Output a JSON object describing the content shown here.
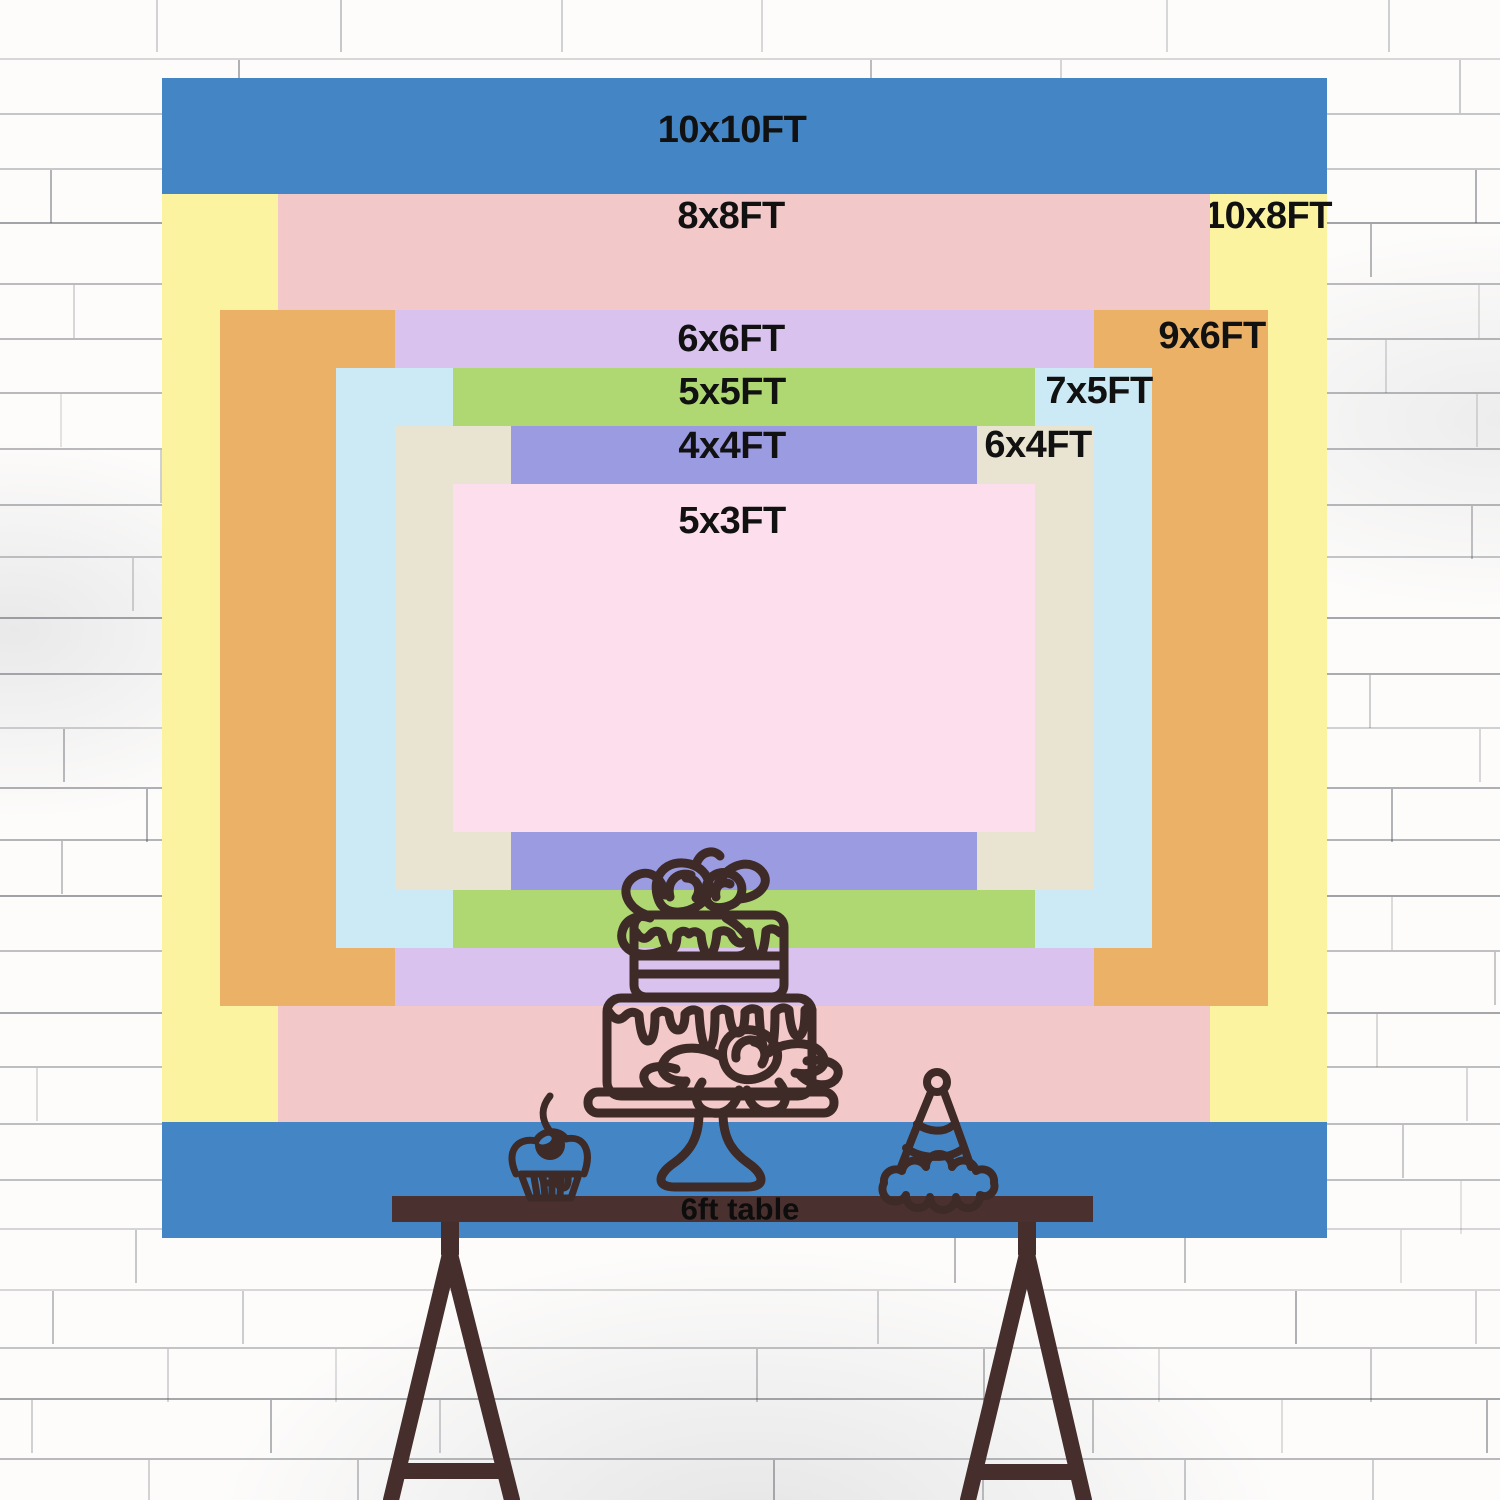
{
  "image_type": "backdrop size comparison chart",
  "wall": {
    "description": "white painted brick wall",
    "base_color": "#fdfcfb",
    "mortar_line_color": "#4b4f58"
  },
  "sizes": [
    {
      "label": "10x10FT",
      "width_ft": 10,
      "height_ft": 10,
      "color": "#4486C5",
      "label_placement": "top-center"
    },
    {
      "label": "10x8FT",
      "width_ft": 10,
      "height_ft": 8,
      "color": "#FBF3A0",
      "label_placement": "top-right"
    },
    {
      "label": "8x8FT",
      "width_ft": 8,
      "height_ft": 8,
      "color": "#F3C8C9",
      "label_placement": "top-center"
    },
    {
      "label": "9x6FT",
      "width_ft": 9,
      "height_ft": 6,
      "color": "#EAB167",
      "label_placement": "top-right"
    },
    {
      "label": "6x6FT",
      "width_ft": 6,
      "height_ft": 6,
      "color": "#D9C3EE",
      "label_placement": "top-center"
    },
    {
      "label": "7x5FT",
      "width_ft": 7,
      "height_ft": 5,
      "color": "#CBEAF6",
      "label_placement": "top-right"
    },
    {
      "label": "5x5FT",
      "width_ft": 5,
      "height_ft": 5,
      "color": "#AFD873",
      "label_placement": "top-center"
    },
    {
      "label": "6x4FT",
      "width_ft": 6,
      "height_ft": 4,
      "color": "#E9E4D2",
      "label_placement": "top-right"
    },
    {
      "label": "4x4FT",
      "width_ft": 4,
      "height_ft": 4,
      "color": "#9B9BE2",
      "label_placement": "top-center"
    },
    {
      "label": "5x3FT",
      "width_ft": 5,
      "height_ft": 3,
      "color": "#FCDEEC",
      "label_placement": "top-center"
    }
  ],
  "table": {
    "label": "6ft table",
    "length_ft": 6,
    "top_color": "#4A3130",
    "leg_color": "#452E2C"
  },
  "decorations": {
    "line_color": "#3E2A26",
    "items": [
      "two-tier drip cake with roses on stand",
      "cupcake with cherry",
      "striped party hat"
    ]
  },
  "label_text_color": "#111111"
}
